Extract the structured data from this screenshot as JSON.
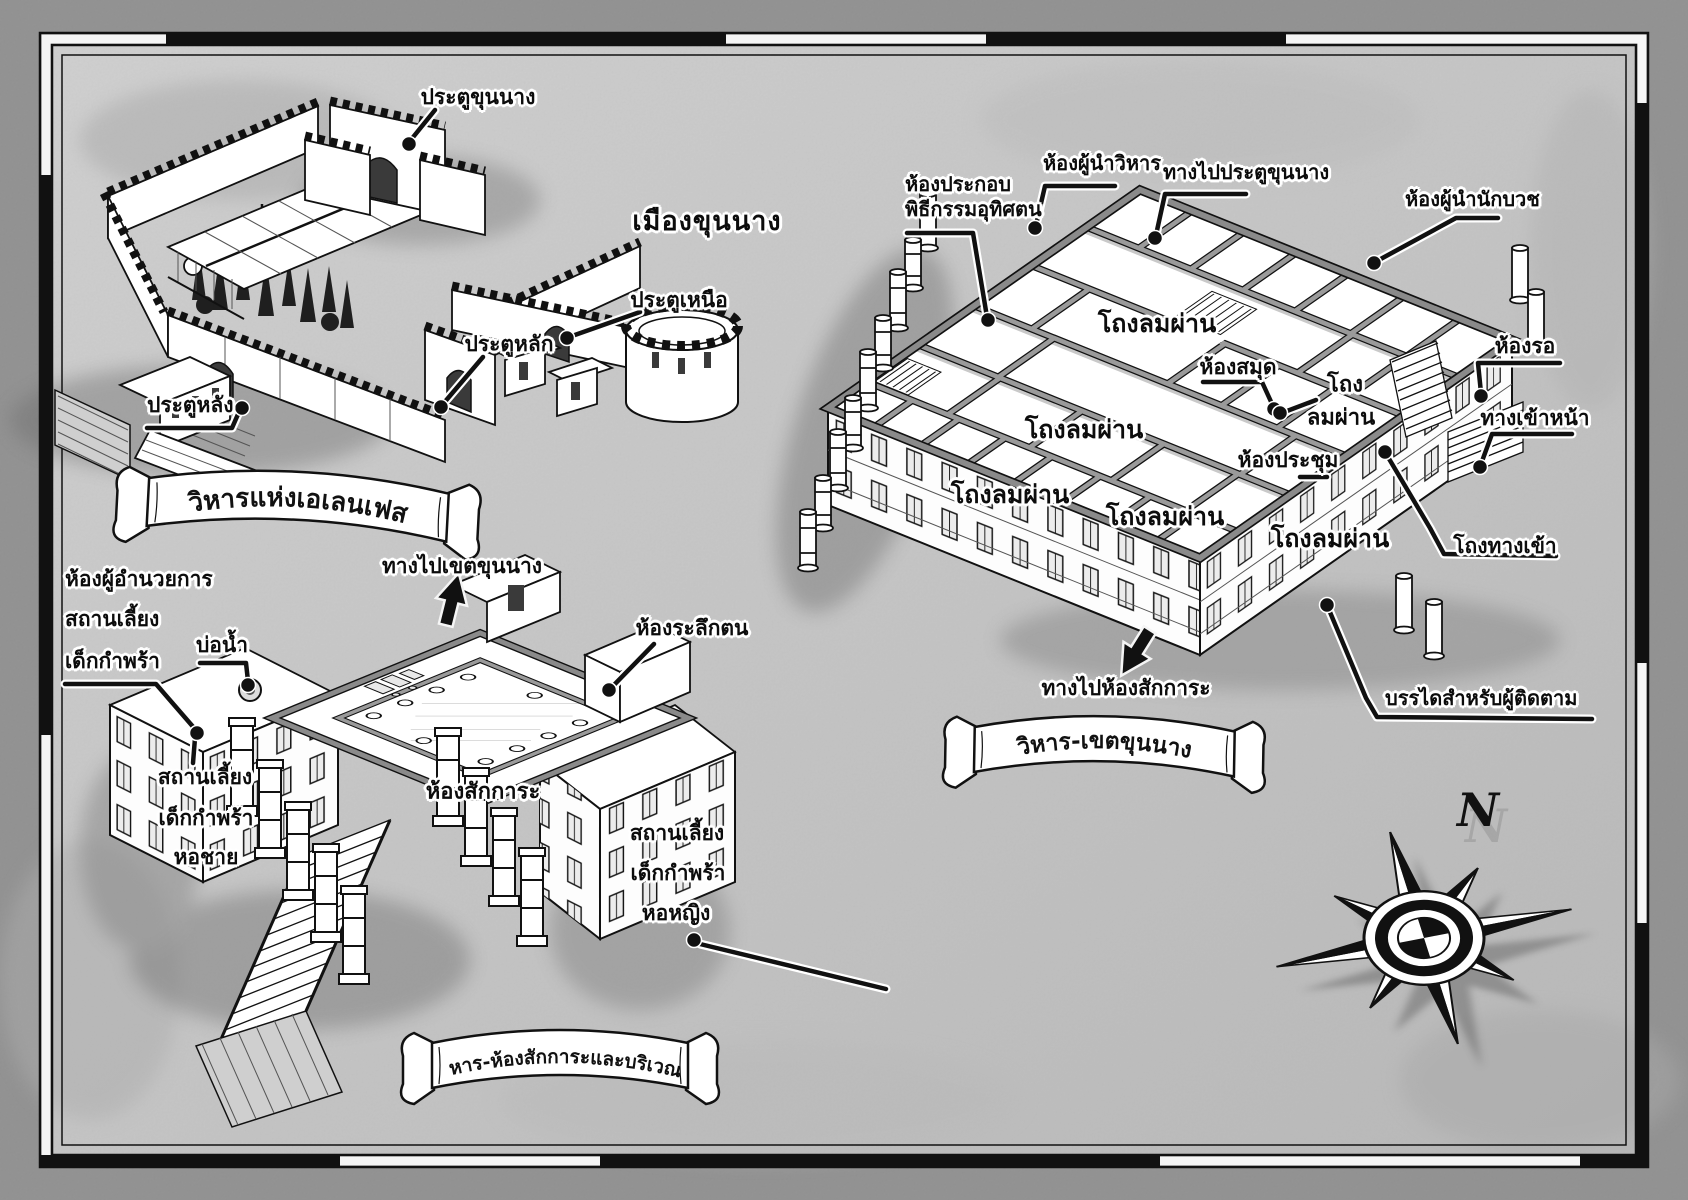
{
  "title": "เมืองขุนนาง",
  "compass": {
    "north": "N"
  },
  "banners": {
    "elenfes": "วิหารแห่งเอเลนเฟส",
    "noble_area": "วิหาร-เขตขุนนาง",
    "worship_area": "วิหาร-ห้องสักการะและบริเวณ"
  },
  "labels": {
    "noble_gate": "ประตูขุนนาง",
    "north_gate": "ประตูเหนือ",
    "main_gate": "ประตูหลัก",
    "rear_gate": "ประตูหลัง",
    "dedication_room_l1": "ห้องประกอบ",
    "dedication_room_l2": "พิธีกรรมอุทิศตน",
    "temple_head_room": "ห้องผู้นำวิหาร",
    "to_noble_gate": "ทางไปประตูขุนนาง",
    "priest_head_room": "ห้องผู้นำนักบวช",
    "wind_hall": "โถงลมผ่าน",
    "wind_hall_l1": "โถง",
    "wind_hall_l2": "ลมผ่าน",
    "library": "ห้องสมุด",
    "waiting_room": "ห้องรอ",
    "front_entrance": "ทางเข้าหน้า",
    "meeting_room": "ห้องประชุม",
    "entrance_hall": "โถงทางเข้า",
    "to_worship_room": "ทางไปห้องสักการะ",
    "attendant_stairs": "บรรไดสำหรับผู้ติดตาม",
    "orphanage_director_l1": "ห้องผู้อำนวยการ",
    "orphanage_director_l2": "สถานเลี้ยง",
    "orphanage_director_l3": "เด็กกำพร้า",
    "well": "บ่อน้ำ",
    "to_noble_area": "ทางไปเขตขุนนาง",
    "reflection_room": "ห้องระลึกตน",
    "orphanage_l1": "สถานเลี้ยง",
    "orphanage_l2": "เด็กกำพร้า",
    "boys_dorm": "หอชาย",
    "worship_room": "ห้องสักการะ",
    "girls_dorm": "หอหญิง"
  },
  "colors": {
    "ink": "#111111",
    "paper_outer": "#8f8f8f",
    "paper_inner": "#c9c9c9",
    "wall_gray": "#8a8a8a"
  }
}
